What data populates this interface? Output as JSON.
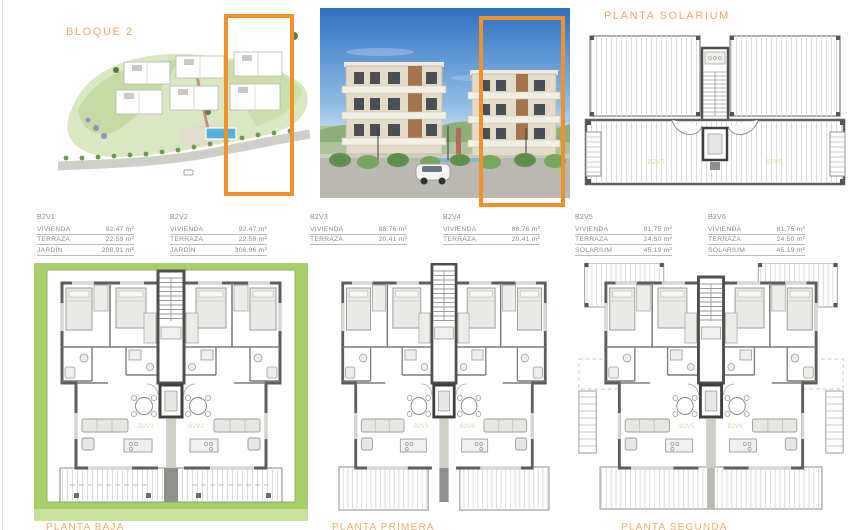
{
  "header": {
    "bloque_label": "BLOQUE 2",
    "solarium_label": "PLANTA SOLARIUM"
  },
  "units": [
    {
      "id": "B2V1",
      "rows": [
        [
          "VIVIENDA",
          "92.47 m²"
        ],
        [
          "TERRAZA",
          "22.59 m²"
        ],
        [
          "JARDÍN",
          "208.91 m²"
        ]
      ]
    },
    {
      "id": "B2V2",
      "rows": [
        [
          "VIVIENDA",
          "92.47 m²"
        ],
        [
          "TERRAZA",
          "22.59 m²"
        ],
        [
          "JARDÍN",
          "306.96 m²"
        ]
      ]
    },
    {
      "id": "B2V3",
      "rows": [
        [
          "VIVIENDA",
          "88.76 m²"
        ],
        [
          "TERRAZA",
          "20.41 m²"
        ]
      ]
    },
    {
      "id": "B2V4",
      "rows": [
        [
          "VIVIENDA",
          "88.76 m²"
        ],
        [
          "TERRAZA",
          "20.41 m²"
        ]
      ]
    },
    {
      "id": "B2V5",
      "rows": [
        [
          "VIVIENDA",
          "81.75 m²"
        ],
        [
          "TERRAZA",
          "24.50 m²"
        ],
        [
          "SOLARIUM",
          "45.19 m²"
        ]
      ]
    },
    {
      "id": "B2V6",
      "rows": [
        [
          "VIVIENDA",
          "81.75 m²"
        ],
        [
          "TERRAZA",
          "24.50 m²"
        ],
        [
          "SOLARIUM",
          "45.19 m²"
        ]
      ]
    }
  ],
  "plans": [
    {
      "caption": "PLANTA BAJA",
      "left_unit": "B2V1",
      "right_unit": "B2V2"
    },
    {
      "caption": "PLANTA PRIMERA",
      "left_unit": "B2V3",
      "right_unit": "B2V4"
    },
    {
      "caption": "PLANTA SEGUNDA",
      "left_unit": "B2V5",
      "right_unit": "B2V6"
    }
  ],
  "solarium_units": {
    "left": "B2V5",
    "right": "B2V6"
  },
  "colors": {
    "accent_orange": "#F0922B",
    "label_orange": "#E9A96B",
    "garden_green": "#A8CF6B"
  }
}
